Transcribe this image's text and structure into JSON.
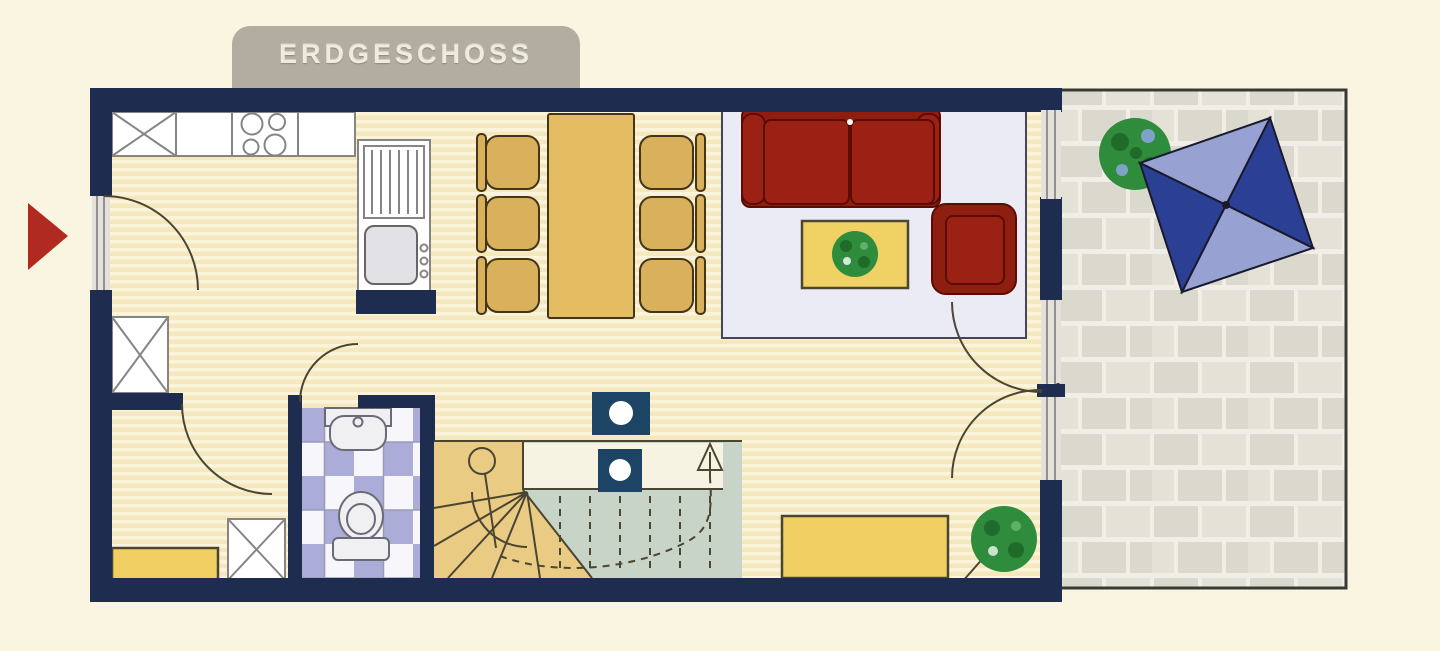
{
  "title": {
    "label": "ERDGESCHOSS"
  },
  "palette": {
    "bg": "#faf5e1",
    "wall": "#1e2c50",
    "tabBg": "#b3aca0",
    "tabText": "#eeeade",
    "arrowRed": "#b02a21",
    "floorA": "#f5e8bc",
    "floorB": "#fbf4da",
    "counterWhite": "#ffffff",
    "counterLine": "#858585",
    "wood": "#d9b15c",
    "tableWood": "#e4bd62",
    "woodDark": "#44351a",
    "sofaRed": "#8e1f10",
    "sofaIn": "#9a2113",
    "sofaDeep": "#5a0c05",
    "rug": "#ebebf6",
    "rugLine": "#44445e",
    "cTable": "#efd164",
    "benchYellow": "#f0ce62",
    "green": "#2f8c3c",
    "greenDark": "#1f6b2a",
    "paver": "#dbd8ce",
    "paverAlt": "#e4e1d7",
    "paverJoint": "#f0eee6",
    "umbDark": "#2b3f94",
    "umbLight": "#97a1d2",
    "stairGreen": "#c9d4c9",
    "stairTan": "#eacb84",
    "landing": "#f7f3e2",
    "tileLav": "#acacd8",
    "tileWhite": "#f6f6fb",
    "fixture": "#f0f0f2",
    "line": "#4a4632",
    "colNavy": "#1d4365",
    "glass": "#e3e1d9"
  }
}
